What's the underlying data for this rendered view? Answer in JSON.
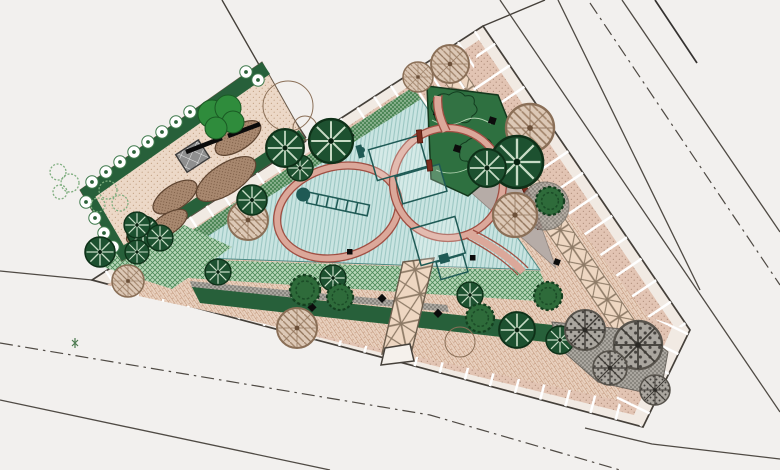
{
  "drawing": {
    "kind": "landscape-site-plan",
    "site": {
      "shape": "triangular park block with chamfered south-east corner",
      "zones": [
        {
          "name": "perimeter-sidewalk",
          "surface": "pink stippled paving with white joint lines"
        },
        {
          "name": "diamond-paving-band",
          "surface": "square pavers with X diagonals along north-east edge"
        },
        {
          "name": "interior-paving",
          "surface": "brick running-bond paving"
        },
        {
          "name": "playground",
          "surface": "teal striped safety surface with red loop track"
        },
        {
          "name": "apex-planting-bed",
          "surface": "dark green shrub bed"
        },
        {
          "name": "lawn-strips",
          "surface": "green woven-hatch ground cover"
        },
        {
          "name": "hedge-band",
          "surface": "dark green hedge with shrub markers"
        },
        {
          "name": "gravel-plaza",
          "surface": "dark stippled gravel with trees"
        },
        {
          "name": "entrance-walkway",
          "surface": "X-pattern paving with entry apron"
        }
      ]
    },
    "garden_plot": {
      "shape": "rotated rectangle at north-west",
      "features": [
        "flowering hedge rows",
        "earth mounds",
        "gray pergola structure",
        "bright tree mass",
        "conifer row"
      ]
    },
    "roads": {
      "solid_edge_lines": 8,
      "dash_dot_centerlines": 2
    },
    "vegetation": {
      "conifer_trees": 16,
      "canopy_trees": 9,
      "gravel_area_trees": 4,
      "scribble_shrubs": 5,
      "hedge_flowers": 16
    },
    "playground_items": {
      "equipment_frames": 4,
      "slide_structure": 1,
      "benches": 4,
      "loop_track_loops": 2
    }
  },
  "palette": {
    "bg": "#f2f0ee",
    "road": "#4f4a44",
    "lot": "#45403a",
    "paving-light": "#f1eae3",
    "paving-pink": "#e2c4b3",
    "paving-dot": "#b4927f",
    "garden-tan": "#ecd8c7",
    "garden-dot": "#c3a285",
    "x-bg": "#eed7c2",
    "x-line": "#8d7a66",
    "herring": "#e9d1bf",
    "herring-line": "#c09579",
    "green-dark": "#27603a",
    "bed-green": "#2e7040",
    "lawn": "#b9d7ba",
    "lawn-line": "#4c8a58",
    "strip-green": "#4d8757",
    "strip-dot": "#d9e7d6",
    "teal": "#c9e4e1",
    "teal-line": "#9cc7c3",
    "gray-wedge": "#b6aca7",
    "gravel": "#aaa69f",
    "gravel-dot": "#474440",
    "mound": "#a8886f",
    "mound-dot": "#6f5039",
    "mound-edge": "#5f4531",
    "track-fill": "#dba89a",
    "track-edge": "#a04f43",
    "equip": "#1f5a55",
    "bench": "#7b2d1f",
    "tree-dark": "#1d5130",
    "canopy-edge": "#8a6f57",
    "structure": "#8f8f8f",
    "bright-green": "#2f8c3c",
    "flower": "#3f7a4c",
    "black": "#0c0c0c"
  }
}
